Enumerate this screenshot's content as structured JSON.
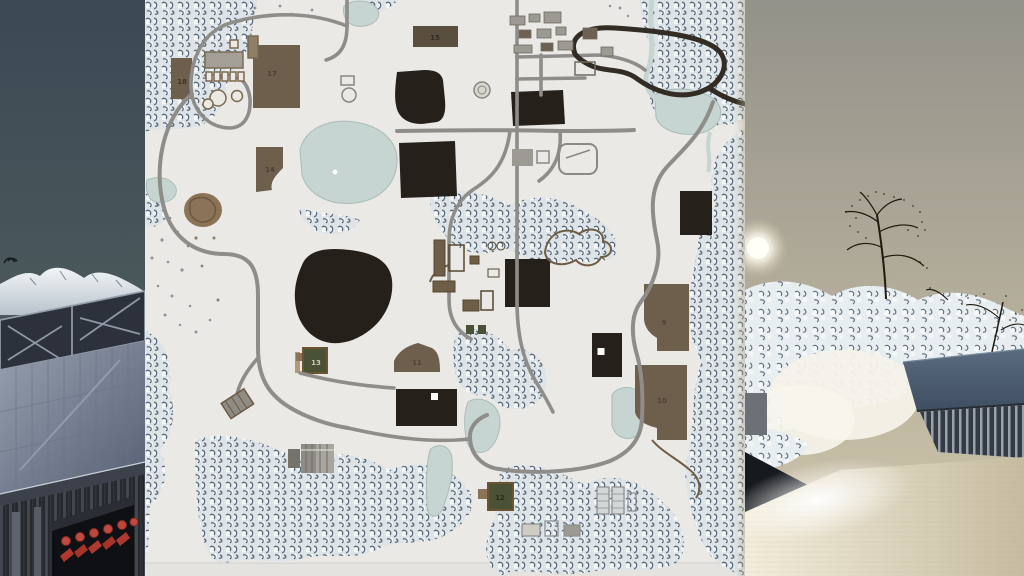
{
  "map": {
    "fields": [
      {
        "label": "9"
      },
      {
        "label": "10"
      },
      {
        "label": "11"
      },
      {
        "label": "12"
      },
      {
        "label": "13"
      },
      {
        "label": "14"
      },
      {
        "label": "15"
      },
      {
        "label": "17"
      },
      {
        "label": "18"
      }
    ],
    "colors": {
      "snow": "#e9e8e3",
      "forest": "#3f5468",
      "road": "#8e8d89",
      "racetrack": "#322c24",
      "field_dark": "#26201a",
      "field_brown": "#6d5f4b",
      "field_green": "#4b5134",
      "water": "#c6d5d1",
      "label_dark": "#4b443a",
      "label_light": "#cfccba"
    },
    "markers": [
      {
        "name": "white-square-marker"
      },
      {
        "name": "white-square-marker"
      },
      {
        "name": "white-dot-marker"
      }
    ]
  },
  "background": {
    "left": {
      "sky_top": "#3b4954",
      "sky_bottom": "#636c60",
      "elements": [
        "snowy-mountains",
        "bird",
        "barn-roof-skylight",
        "equipment-shed",
        "red-implements"
      ]
    },
    "right": {
      "sky_top": "#93928a",
      "sky_bottom": "#d3c8ad",
      "sun_color": "#fffef7",
      "elements": [
        "sun",
        "bare-tree",
        "snowy-hill",
        "barn",
        "sunlit-roof"
      ]
    }
  }
}
